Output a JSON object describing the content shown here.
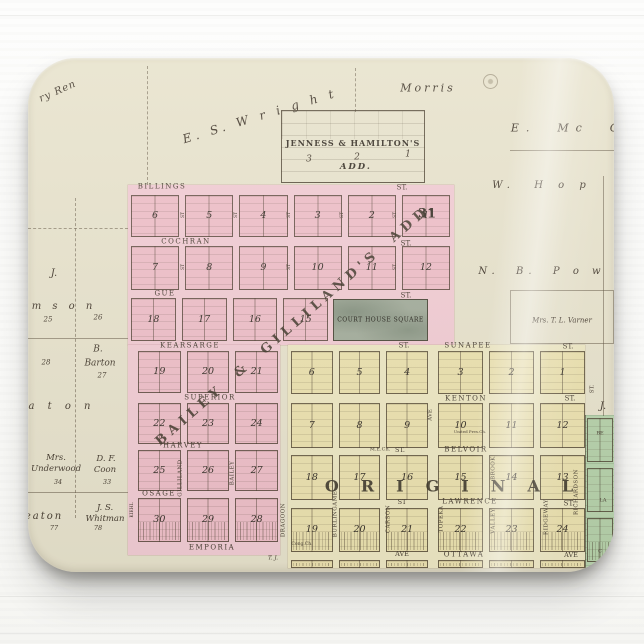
{
  "colors": {
    "map_paper": "#e8e3cd",
    "pink_addition": "#f2c6cf",
    "yellow_original": "#ece3b6",
    "green_strip": "#b9d4ae",
    "court_square": "#a5ae9d"
  },
  "map": {
    "additions": {
      "jenness_title": "JENNESS & HAMILTON'S",
      "jenness_add": "ADD.",
      "bailey_diagonal": "BAILEY & GILLILAND'S ADD.",
      "original": "ORIGINAL",
      "section_number": "31",
      "court_house_square": "COURT HOUSE SQUARE"
    },
    "labels": [
      {
        "n": "street-billings",
        "t": "BILLINGS",
        "x": 134,
        "y": 129,
        "s": 7,
        "ls": 1.5
      },
      {
        "n": "street-billings-st",
        "t": "ST.",
        "x": 374,
        "y": 130,
        "s": 7
      },
      {
        "n": "street-cochran",
        "t": "COCHRAN",
        "x": 158,
        "y": 184,
        "s": 7,
        "ls": 1.5
      },
      {
        "n": "street-cochran-st",
        "t": "ST.",
        "x": 378,
        "y": 186,
        "s": 7
      },
      {
        "n": "street-gue",
        "t": "GUE",
        "x": 137,
        "y": 236,
        "s": 7,
        "ls": 1.5
      },
      {
        "n": "street-gue-st",
        "t": "ST.",
        "x": 378,
        "y": 238,
        "s": 7
      },
      {
        "n": "street-kearsarge",
        "t": "KEARSARGE",
        "x": 162,
        "y": 288,
        "s": 7,
        "ls": 1.5
      },
      {
        "n": "street-kearsarge-st",
        "t": "ST.",
        "x": 376,
        "y": 288,
        "s": 7
      },
      {
        "n": "street-sunapee",
        "t": "SUNAPEE",
        "x": 440,
        "y": 288,
        "s": 7,
        "ls": 1.5
      },
      {
        "n": "street-sunapee-st",
        "t": "ST.",
        "x": 540,
        "y": 289,
        "s": 7
      },
      {
        "n": "street-superior",
        "t": "SUPERIOR",
        "x": 182,
        "y": 340,
        "s": 7,
        "ls": 1.5
      },
      {
        "n": "street-kenton",
        "t": "KENTON",
        "x": 438,
        "y": 341,
        "s": 7,
        "ls": 1.5
      },
      {
        "n": "street-kenton-st",
        "t": "ST.",
        "x": 542,
        "y": 341,
        "s": 7
      },
      {
        "n": "street-harvey",
        "t": "HARVEY",
        "x": 155,
        "y": 388,
        "s": 7,
        "ls": 1.5
      },
      {
        "n": "label-me-church",
        "t": "M.E.Ch.",
        "x": 352,
        "y": 392,
        "s": 5
      },
      {
        "n": "street-belvoir-st-w",
        "t": "ST.",
        "x": 372,
        "y": 392,
        "s": 6.5
      },
      {
        "n": "street-belvoir",
        "t": "BELVOIR",
        "x": 438,
        "y": 392,
        "s": 7,
        "ls": 1.5
      },
      {
        "n": "street-osage",
        "t": "OSAGE",
        "x": 131,
        "y": 436,
        "s": 7,
        "ls": 1.5
      },
      {
        "n": "street-lawrence-st-w",
        "t": "ST",
        "x": 374,
        "y": 444,
        "s": 6.5
      },
      {
        "n": "street-lawrence",
        "t": "LAWRENCE",
        "x": 442,
        "y": 444,
        "s": 7,
        "ls": 1.5
      },
      {
        "n": "street-lawrence-st-e",
        "t": "ST.",
        "x": 541,
        "y": 446,
        "s": 7
      },
      {
        "n": "street-emporia",
        "t": "EMPORIA",
        "x": 184,
        "y": 490,
        "s": 7,
        "ls": 1.5
      },
      {
        "n": "street-ottawa-ave-w",
        "t": "AVE",
        "x": 374,
        "y": 496,
        "s": 6.5
      },
      {
        "n": "street-ottawa",
        "t": "OTTAWA",
        "x": 436,
        "y": 497,
        "s": 7,
        "ls": 1.5
      },
      {
        "n": "street-ottawa-ave-e",
        "t": "AVE",
        "x": 543,
        "y": 497,
        "s": 6.5
      },
      {
        "n": "street-kiehl",
        "t": "KIEHL",
        "x": 105,
        "y": 452,
        "s": 4.5,
        "r": -90
      },
      {
        "n": "street-gilliland",
        "t": "GILLILAND",
        "x": 153,
        "y": 420,
        "s": 5.5,
        "r": -90,
        "ls": 0.5
      },
      {
        "n": "street-bailey",
        "t": "BAILEY",
        "x": 205,
        "y": 415,
        "s": 5.5,
        "r": -90,
        "ls": 0.5
      },
      {
        "n": "street-dragoon",
        "t": "DRAGOON",
        "x": 256,
        "y": 462,
        "s": 5.5,
        "r": -90,
        "ls": 0.5
      },
      {
        "n": "street-burlingame",
        "t": "BURLINGAME",
        "x": 308,
        "y": 456,
        "s": 5.5,
        "r": -90,
        "ls": 0.5
      },
      {
        "n": "street-carson",
        "t": "CARSON",
        "x": 361,
        "y": 461,
        "s": 5.5,
        "r": -90,
        "ls": 0.5
      },
      {
        "n": "street-topeka",
        "t": "TOPEKA",
        "x": 414,
        "y": 461,
        "s": 5.5,
        "r": -90,
        "ls": 0.5
      },
      {
        "n": "street-topeka-ave",
        "t": "AVE",
        "x": 403,
        "y": 357,
        "s": 5.5,
        "r": -90
      },
      {
        "n": "street-brook",
        "t": "BROOK",
        "x": 466,
        "y": 410,
        "s": 5.5,
        "r": -90,
        "ls": 0.5
      },
      {
        "n": "street-valley",
        "t": "VALLEY",
        "x": 466,
        "y": 463,
        "s": 5.5,
        "r": -90,
        "ls": 0.5
      },
      {
        "n": "street-ridgeway",
        "t": "RIDGEWAY",
        "x": 519,
        "y": 459,
        "s": 5.5,
        "r": -90,
        "ls": 0.5
      },
      {
        "n": "street-richardson",
        "t": "RICHARDSON",
        "x": 549,
        "y": 434,
        "s": 5.5,
        "r": -90,
        "ls": 0.5
      },
      {
        "n": "street-st-right-edge",
        "t": "ST.",
        "x": 565,
        "y": 331,
        "s": 5.5,
        "r": -90
      },
      {
        "n": "street-st-v1",
        "t": "ST",
        "x": 156,
        "y": 157,
        "s": 4.5,
        "r": -90
      },
      {
        "n": "street-st-v2",
        "t": "ST",
        "x": 209,
        "y": 157,
        "s": 4.5,
        "r": -90
      },
      {
        "n": "street-st-v3",
        "t": "ST",
        "x": 262,
        "y": 157,
        "s": 4.5,
        "r": -90
      },
      {
        "n": "street-st-v4",
        "t": "ST",
        "x": 315,
        "y": 157,
        "s": 4.5,
        "r": -90
      },
      {
        "n": "street-st-v5",
        "t": "ST",
        "x": 368,
        "y": 157,
        "s": 4.5,
        "r": -90
      },
      {
        "n": "street-st-v6",
        "t": "ST",
        "x": 156,
        "y": 209,
        "s": 4.5,
        "r": -90
      },
      {
        "n": "street-st-v7",
        "t": "ST",
        "x": 262,
        "y": 209,
        "s": 4.5,
        "r": -90
      },
      {
        "n": "street-st-v8",
        "t": "ST",
        "x": 368,
        "y": 209,
        "s": 4.5,
        "r": -90
      },
      {
        "n": "green-street-be",
        "t": "BE",
        "x": 572,
        "y": 376,
        "s": 5
      },
      {
        "n": "green-street-la",
        "t": "LA",
        "x": 575,
        "y": 443,
        "s": 5
      },
      {
        "n": "green-street-c",
        "t": "C",
        "x": 572,
        "y": 494,
        "s": 5
      },
      {
        "n": "owner-morris",
        "t": "Morris",
        "x": 400,
        "y": 30,
        "s": 11,
        "i": 1,
        "ls": 3
      },
      {
        "n": "owner-es-wright",
        "t": "E. S. W r i g h t",
        "x": 232,
        "y": 58,
        "s": 12,
        "i": 1,
        "ls": 4,
        "r": -17
      },
      {
        "n": "owner-ren",
        "t": "ry Ren",
        "x": 30,
        "y": 34,
        "s": 10,
        "i": 1,
        "ls": 1,
        "r": -24
      },
      {
        "n": "owner-e-mc",
        "t": "E.  Mc  C",
        "x": 540,
        "y": 70,
        "s": 11,
        "i": 1,
        "ls": 7
      },
      {
        "n": "owner-w-hop",
        "t": "W.  H o p",
        "x": 514,
        "y": 128,
        "s": 10,
        "i": 1,
        "ls": 6
      },
      {
        "n": "owner-nb-pow",
        "t": "N.  B.  P o w",
        "x": 514,
        "y": 214,
        "s": 10,
        "i": 1,
        "ls": 5
      },
      {
        "n": "owner-varner",
        "t": "Mrs. T. L. Varner",
        "x": 534,
        "y": 263,
        "s": 7,
        "i": 1
      },
      {
        "n": "owner-j-left",
        "t": "J.",
        "x": 26,
        "y": 216,
        "s": 10,
        "i": 1
      },
      {
        "n": "owner-j-right",
        "t": "J.",
        "x": 575,
        "y": 349,
        "s": 10,
        "i": 1
      },
      {
        "n": "owner-amson",
        "t": "m s o n",
        "x": 36,
        "y": 249,
        "s": 10,
        "i": 1,
        "ls": 4
      },
      {
        "n": "parcel-25",
        "t": "25",
        "x": 20,
        "y": 262,
        "s": 7,
        "i": 1
      },
      {
        "n": "parcel-26",
        "t": "26",
        "x": 70,
        "y": 260,
        "s": 7,
        "i": 1
      },
      {
        "n": "owner-barton-b",
        "t": "B.",
        "x": 70,
        "y": 292,
        "s": 9,
        "i": 1
      },
      {
        "n": "owner-barton",
        "t": "Barton",
        "x": 72,
        "y": 306,
        "s": 9,
        "i": 1
      },
      {
        "n": "parcel-28",
        "t": "28",
        "x": 18,
        "y": 305,
        "s": 7,
        "i": 1
      },
      {
        "n": "parcel-27",
        "t": "27",
        "x": 74,
        "y": 318,
        "s": 7,
        "i": 1
      },
      {
        "n": "owner-aton",
        "t": "a t o n",
        "x": 34,
        "y": 349,
        "s": 10,
        "i": 1,
        "ls": 5
      },
      {
        "n": "owner-underwood-mrs",
        "t": "Mrs.",
        "x": 28,
        "y": 400,
        "s": 8.5,
        "i": 1
      },
      {
        "n": "owner-underwood",
        "t": "Underwood",
        "x": 28,
        "y": 411,
        "s": 8.5,
        "i": 1
      },
      {
        "n": "parcel-34",
        "t": "34",
        "x": 30,
        "y": 424,
        "s": 6.5,
        "i": 1
      },
      {
        "n": "owner-coon-df",
        "t": "D. F.",
        "x": 78,
        "y": 401,
        "s": 8.5,
        "i": 1
      },
      {
        "n": "owner-coon",
        "t": "Coon",
        "x": 77,
        "y": 412,
        "s": 8.5,
        "i": 1
      },
      {
        "n": "parcel-33",
        "t": "33",
        "x": 79,
        "y": 424,
        "s": 6.5,
        "i": 1
      },
      {
        "n": "owner-eaton",
        "t": "eaton",
        "x": 16,
        "y": 459,
        "s": 10,
        "i": 1,
        "ls": 2
      },
      {
        "n": "owner-whitman-js",
        "t": "J. S.",
        "x": 77,
        "y": 450,
        "s": 8.5,
        "i": 1
      },
      {
        "n": "owner-whitman",
        "t": "Whitman",
        "x": 77,
        "y": 461,
        "s": 8.5,
        "i": 1
      },
      {
        "n": "parcel-77",
        "t": "77",
        "x": 26,
        "y": 470,
        "s": 6.5,
        "i": 1
      },
      {
        "n": "parcel-78",
        "t": "78",
        "x": 70,
        "y": 470,
        "s": 6.5,
        "i": 1
      },
      {
        "n": "owner-tj",
        "t": "T. J.",
        "x": 245,
        "y": 501,
        "s": 5.5,
        "i": 1
      },
      {
        "n": "label-cong-ch",
        "t": "Cong.Ch.",
        "x": 274,
        "y": 487,
        "s": 4.5
      },
      {
        "n": "label-united-pres",
        "t": "United Pres.Ch.",
        "x": 442,
        "y": 374,
        "s": 4
      },
      {
        "n": "jenness-block-3",
        "t": "3",
        "x": 281,
        "y": 102,
        "s": 9,
        "i": 1
      },
      {
        "n": "jenness-block-2",
        "t": "2",
        "x": 329,
        "y": 100,
        "s": 9,
        "i": 1
      },
      {
        "n": "jenness-block-1",
        "t": "1",
        "x": 380,
        "y": 97,
        "s": 9,
        "i": 1
      }
    ],
    "block_rows": [
      {
        "area": "pink",
        "x": 103,
        "y": 137,
        "w": 319,
        "h": 42,
        "cells": [
          "6",
          "5",
          "4",
          "3",
          "2",
          "1"
        ]
      },
      {
        "area": "pink",
        "x": 103,
        "y": 188,
        "w": 319,
        "h": 44,
        "cells": [
          "7",
          "8",
          "9",
          "10",
          "11",
          "12"
        ]
      },
      {
        "area": "pink",
        "x": 103,
        "y": 240,
        "w": 197,
        "h": 43,
        "cells": [
          "18",
          "17",
          "16",
          "15"
        ]
      },
      {
        "area": "pink",
        "x": 110,
        "y": 293,
        "w": 140,
        "h": 42,
        "cells": [
          "19",
          "20",
          "21"
        ]
      },
      {
        "area": "pink",
        "x": 110,
        "y": 345,
        "w": 140,
        "h": 41,
        "cells": [
          "22",
          "23",
          "24"
        ]
      },
      {
        "area": "pink",
        "x": 110,
        "y": 392,
        "w": 140,
        "h": 41,
        "cells": [
          "25",
          "26",
          "27"
        ]
      },
      {
        "area": "pink",
        "x": 110,
        "y": 440,
        "w": 140,
        "h": 44,
        "cells": [
          "30",
          "29",
          "28"
        ],
        "hatch": true
      },
      {
        "area": "yellow",
        "x": 263,
        "y": 293,
        "w": 137,
        "h": 43,
        "cells": [
          "6",
          "5",
          "4"
        ]
      },
      {
        "area": "yellow",
        "x": 410,
        "y": 293,
        "w": 147,
        "h": 43,
        "cells": [
          "3",
          "2",
          "1"
        ]
      },
      {
        "area": "yellow",
        "x": 263,
        "y": 345,
        "w": 137,
        "h": 45,
        "cells": [
          "7",
          "8",
          "9"
        ]
      },
      {
        "area": "yellow",
        "x": 410,
        "y": 345,
        "w": 147,
        "h": 45,
        "cells": [
          "10",
          "11",
          "12"
        ]
      },
      {
        "area": "yellow",
        "x": 263,
        "y": 397,
        "w": 137,
        "h": 45,
        "cells": [
          "18",
          "17",
          "16"
        ]
      },
      {
        "area": "yellow",
        "x": 410,
        "y": 397,
        "w": 147,
        "h": 45,
        "cells": [
          "15",
          "14",
          "13"
        ]
      },
      {
        "area": "yellow",
        "x": 263,
        "y": 450,
        "w": 137,
        "h": 44,
        "cells": [
          "19",
          "20",
          "21"
        ],
        "hatch": true
      },
      {
        "area": "yellow",
        "x": 410,
        "y": 450,
        "w": 147,
        "h": 44,
        "cells": [
          "22",
          "23",
          "24"
        ],
        "hatch": true
      },
      {
        "area": "yellow",
        "x": 263,
        "y": 502,
        "w": 137,
        "h": 8,
        "cells": [
          "",
          "",
          ""
        ],
        "hatch": true
      },
      {
        "area": "yellow",
        "x": 410,
        "y": 502,
        "w": 147,
        "h": 8,
        "cells": [
          "",
          "",
          ""
        ],
        "hatch": true
      },
      {
        "area": "green",
        "x": 559,
        "y": 360,
        "w": 26,
        "h": 44,
        "cells": [
          ""
        ]
      },
      {
        "area": "green",
        "x": 559,
        "y": 410,
        "w": 26,
        "h": 44,
        "cells": [
          ""
        ]
      },
      {
        "area": "green",
        "x": 559,
        "y": 460,
        "w": 26,
        "h": 44,
        "cells": [
          ""
        ],
        "hatch": true
      }
    ],
    "lines": [
      {
        "x": 47,
        "y": 140,
        "w": 0,
        "h": 320,
        "d": 1
      },
      {
        "x": 0,
        "y": 280,
        "w": 100,
        "h": 0
      },
      {
        "x": 0,
        "y": 434,
        "w": 100,
        "h": 0
      },
      {
        "x": 0,
        "y": 170,
        "w": 100,
        "h": 0,
        "d": 1
      },
      {
        "x": 119,
        "y": 8,
        "w": 0,
        "h": 119,
        "d": 1
      },
      {
        "x": 327,
        "y": 10,
        "w": 0,
        "h": 44,
        "d": 1
      },
      {
        "x": 482,
        "y": 92,
        "w": 104,
        "h": 0
      },
      {
        "x": 575,
        "y": 118,
        "w": 0,
        "h": 240
      }
    ]
  }
}
